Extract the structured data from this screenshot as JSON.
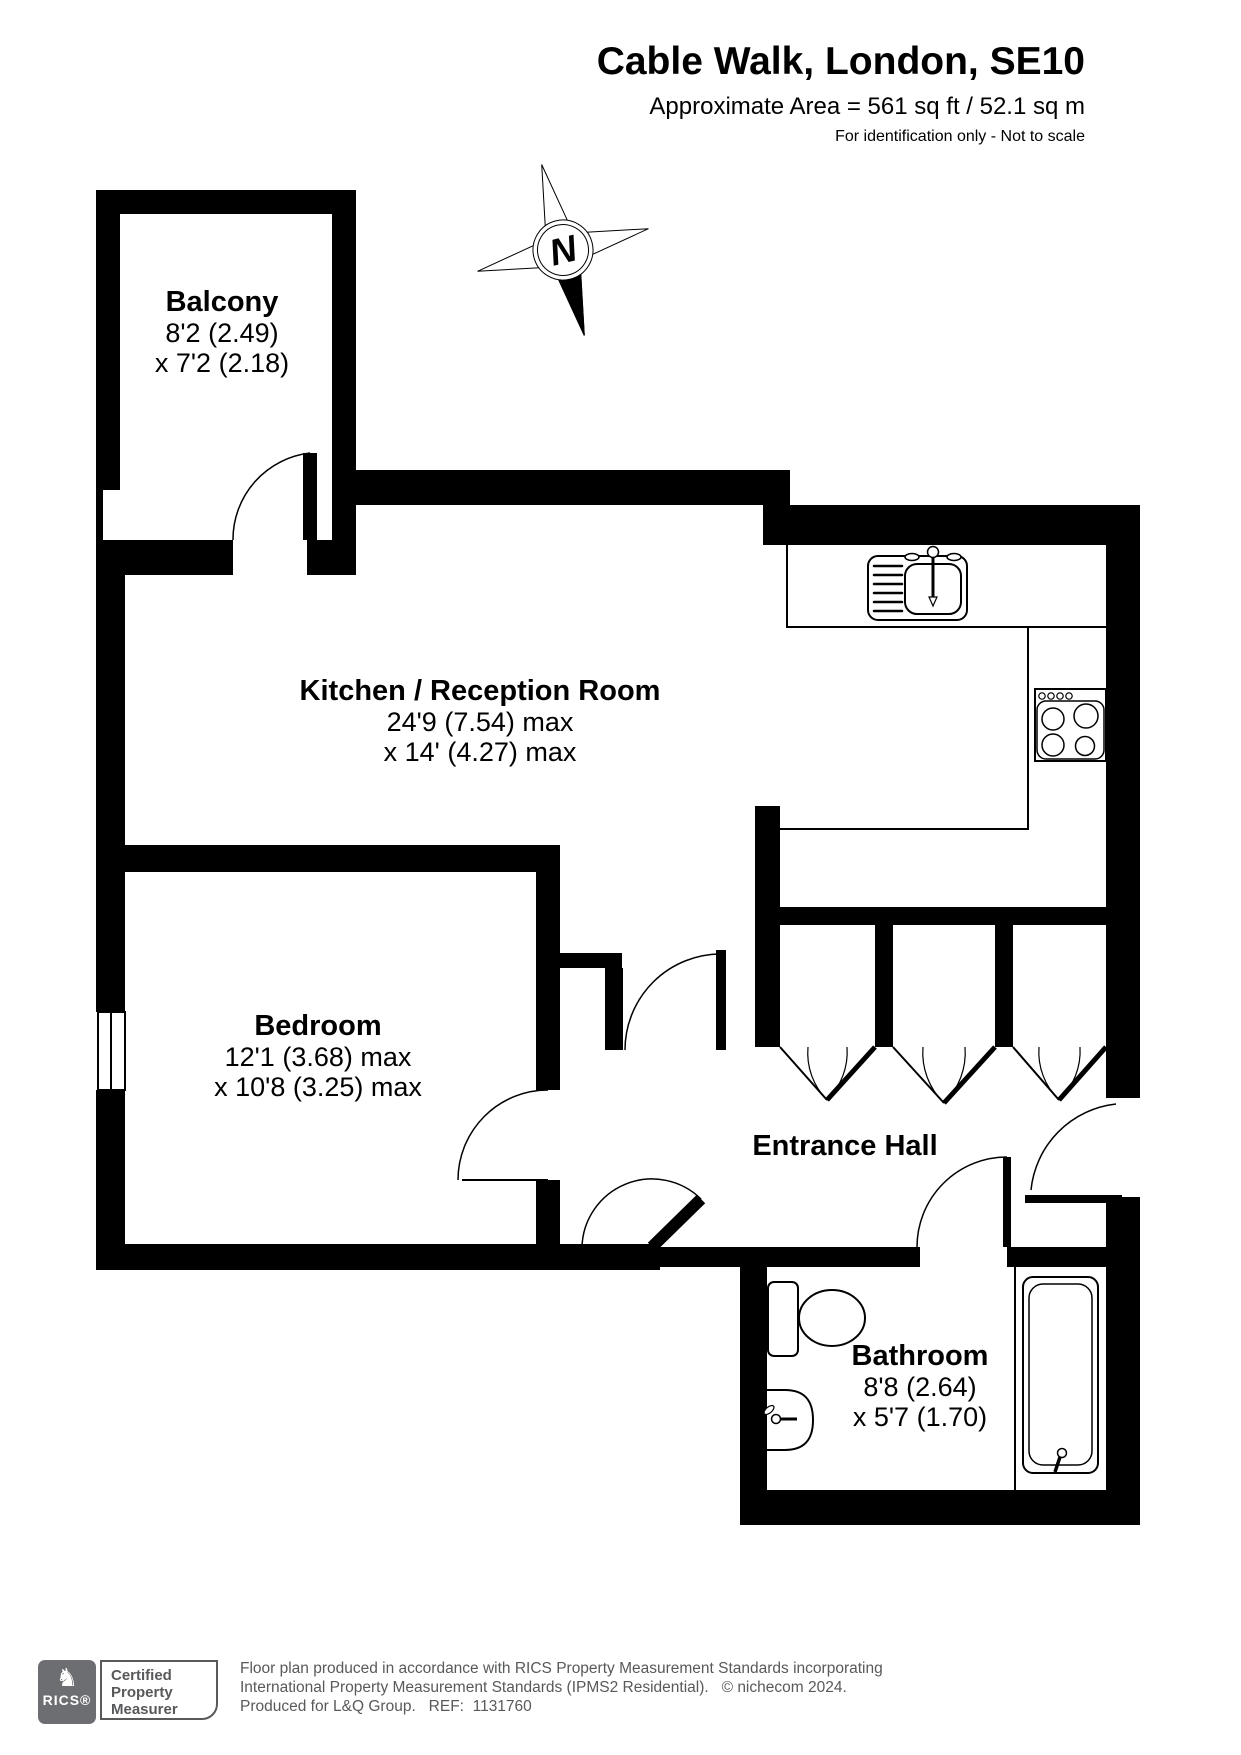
{
  "header": {
    "title": "Cable Walk, London, SE10",
    "area_line": "Approximate Area = 561 sq ft / 52.1 sq m",
    "disclaimer": "For identification only - Not to scale"
  },
  "compass": {
    "north_label": "N"
  },
  "rooms": {
    "balcony": {
      "name": "Balcony",
      "dim1": "8'2 (2.49)",
      "dim2": "x 7'2 (2.18)"
    },
    "kitchen": {
      "name": "Kitchen / Reception Room",
      "dim1": "24'9 (7.54) max",
      "dim2": "x 14' (4.27) max"
    },
    "bedroom": {
      "name": "Bedroom",
      "dim1": "12'1 (3.68) max",
      "dim2": "x 10'8 (3.25) max"
    },
    "hall": {
      "name": "Entrance Hall"
    },
    "bathroom": {
      "name": "Bathroom",
      "dim1": "8'8 (2.64)",
      "dim2": "x 5'7 (1.70)"
    }
  },
  "fixtures": [
    "sink",
    "hob",
    "toilet",
    "basin",
    "bathtub",
    "window"
  ],
  "footer": {
    "logo_text": "RICS®",
    "badge_line1": "Certified",
    "badge_line2": "Property",
    "badge_line3": "Measurer",
    "line1": "Floor plan produced in accordance with RICS Property Measurement Standards incorporating",
    "line2": "International Property Measurement Standards (IPMS2 Residential).   © nichecom 2024.",
    "line3": "Produced for L&Q Group.   REF:  1131760"
  },
  "colors": {
    "wall": "#000000",
    "footer_gray": "#58595b",
    "logo_gray": "#6d6e71",
    "background": "#ffffff"
  }
}
